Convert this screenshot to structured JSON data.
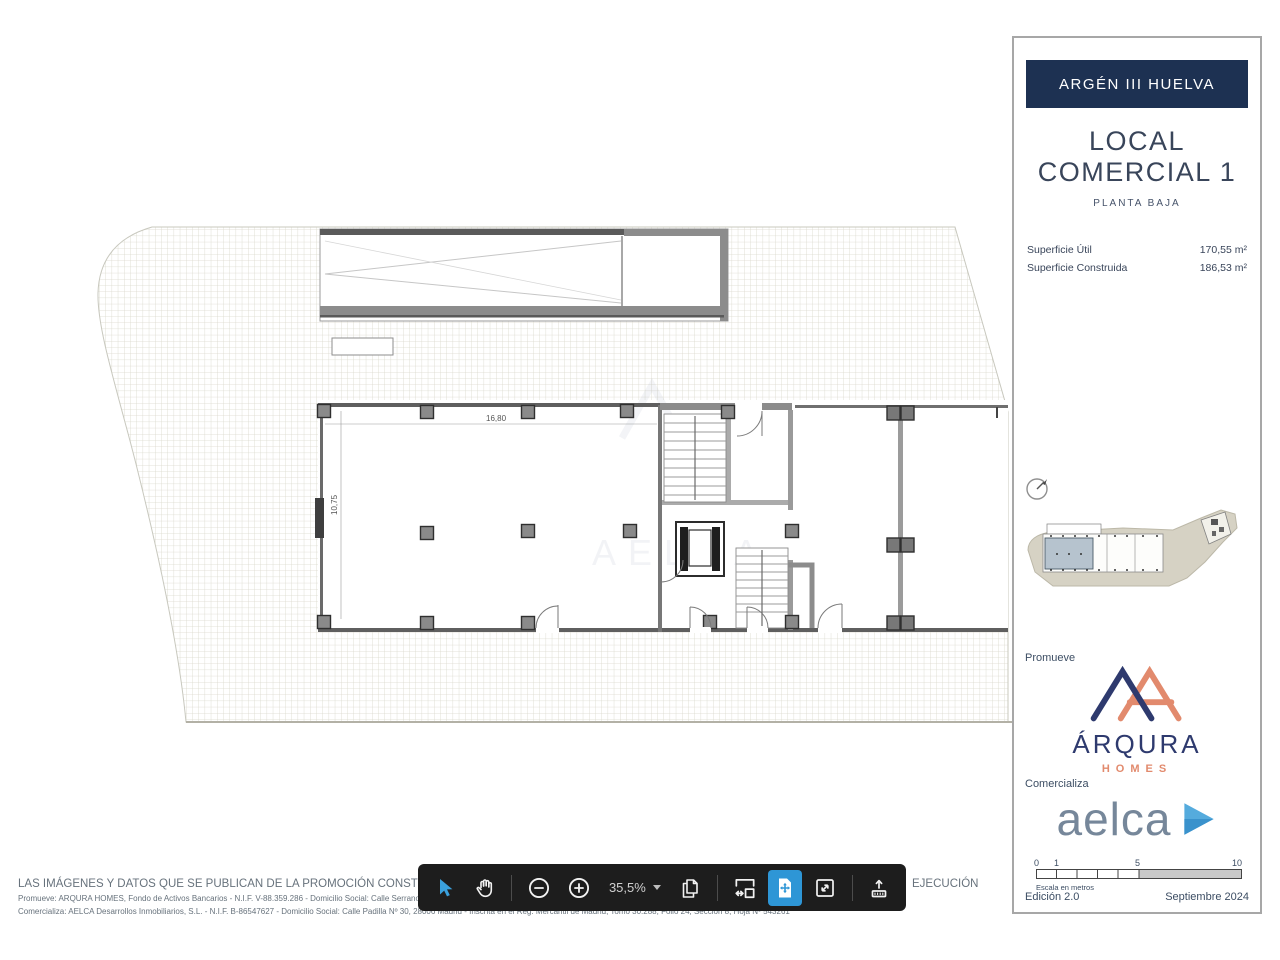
{
  "sidebar": {
    "header": {
      "title": "ARGÉN III HUELVA",
      "bg": "#1d3152"
    },
    "unit": {
      "line1": "LOCAL",
      "line2": "COMERCIAL 1",
      "floor": "PLANTA BAJA"
    },
    "surfaces": [
      {
        "label": "Superficie Útil",
        "value": "170,55 m²"
      },
      {
        "label": "Superficie Construida",
        "value": "186,53 m²"
      }
    ],
    "promoter": {
      "label": "Promueve",
      "brand": "ÁRQURA",
      "brand_sub": "HOMES"
    },
    "agent": {
      "label": "Comercializa",
      "brand": "aelca"
    },
    "scale_bar": {
      "ticks": [
        "0",
        "1",
        "5",
        "10"
      ],
      "caption": "Escala en metros"
    },
    "footer": {
      "edition": "Edición 2.0",
      "date": "Septiembre 2024"
    },
    "colors": {
      "navy": "#1d3152",
      "brand_navy": "#2e3a6e",
      "coral": "#e28a6d",
      "aelca_gray": "#76879a",
      "aelca_blue": "#55abdd"
    }
  },
  "plan": {
    "dim_width_label": "16,80",
    "dim_height_label": "10,75",
    "watermark": "AELCA"
  },
  "toolbar": {
    "zoom_level": "35,5%",
    "active_color": "#2e96d6",
    "tools": [
      "select",
      "pan",
      "zoom-out",
      "zoom-in",
      "zoom-level",
      "copy-pages",
      "fit-width",
      "fit-page",
      "fullscreen",
      "export"
    ]
  },
  "legal": {
    "line1": "LAS IMÁGENES Y DATOS QUE SE PUBLICAN DE LA PROMOCIÓN CONSTITUYEN UNA",
    "line1_tail": "EJECUCIÓN",
    "line2": "Promueve: ARQURA HOMES, Fondo de Activos Bancarios - N.I.F. V-88.359.286 - Domicilio Social: Calle Serrano Nº",
    "line3": "Comercializa: AELCA Desarrollos Inmobiliarios, S.L. - N.I.F. B-86547627 - Domicilio Social: Calle Padilla Nº 30, 28006 Madrid - Inscrita en el Reg. Mercantil de Madrid, Tomo 30.288, Folio 24, Sección 8, Hoja Nº 543261"
  }
}
